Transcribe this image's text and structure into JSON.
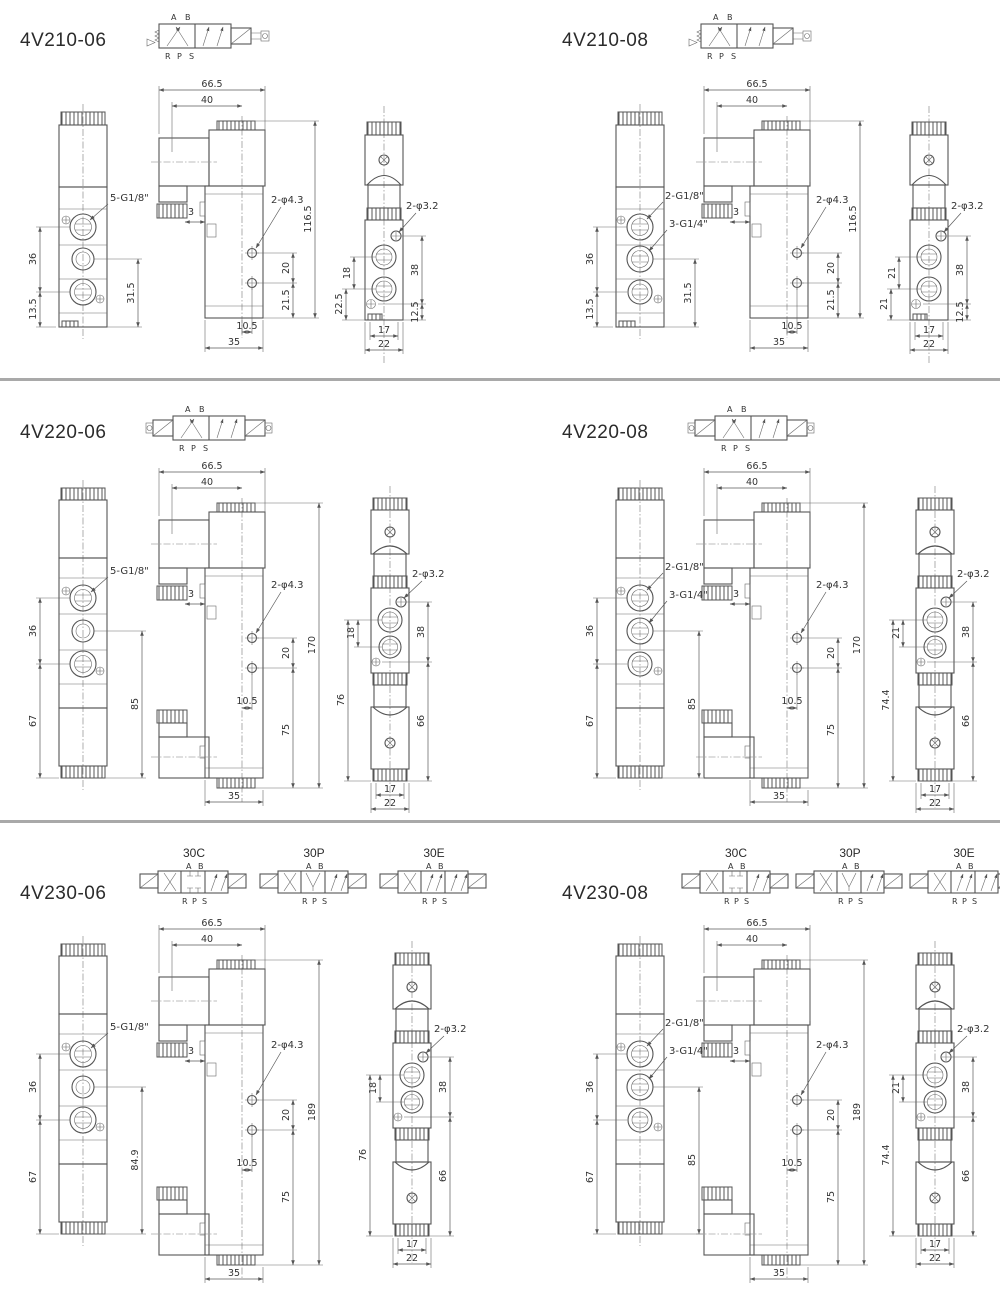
{
  "page": {
    "background": "#ffffff",
    "divider_color": "#a9a9a9",
    "line_color": "#555555"
  },
  "symbols": {
    "ports_top": [
      "A",
      "B"
    ],
    "ports_bottom": [
      "R",
      "P",
      "S"
    ]
  },
  "sections": [
    {
      "title": "4V210-06",
      "valve_type": "5/2 single solenoid spring return",
      "viewA": {
        "thread_label": "5-G1/8\"",
        "dim_span": "36",
        "dim_bottom": "13.5",
        "dim_right": "31.5"
      },
      "viewB": {
        "dim_width": "66.5",
        "dim_width2": "40",
        "dim_offset": "3",
        "hole_label": "2-φ4.3",
        "dim_height": "116.5",
        "dim_h1": "20",
        "dim_h2": "21.5",
        "dim_b1": "10.5",
        "dim_b2": "35"
      },
      "viewC": {
        "hole_label": "2-φ3.2",
        "dim_l1": "18",
        "dim_l2": "22.5",
        "dim_r1": "38",
        "dim_r2": "12.5",
        "dim_b1": "17",
        "dim_b2": "22"
      }
    },
    {
      "title": "4V210-08",
      "valve_type": "5/2 single solenoid spring return",
      "viewA": {
        "thread_label": "2-G1/8\"",
        "thread_label2": "3-G1/4\"",
        "dim_span": "36",
        "dim_bottom": "13.5",
        "dim_right": "31.5"
      },
      "viewB": {
        "dim_width": "66.5",
        "dim_width2": "40",
        "dim_offset": "3",
        "hole_label": "2-φ4.3",
        "dim_height": "116.5",
        "dim_h1": "20",
        "dim_h2": "21.5",
        "dim_b1": "10.5",
        "dim_b2": "35"
      },
      "viewC": {
        "hole_label": "2-φ3.2",
        "dim_l1": "21",
        "dim_l2": "21",
        "dim_r1": "38",
        "dim_r2": "12.5",
        "dim_b1": "17",
        "dim_b2": "22"
      }
    },
    {
      "title": "4V220-06",
      "valve_type": "5/2 double solenoid",
      "viewA": {
        "thread_label": "5-G1/8\"",
        "dim_span": "36",
        "dim_bottom": "67",
        "dim_right": "85"
      },
      "viewB": {
        "dim_width": "66.5",
        "dim_width2": "40",
        "dim_offset": "3",
        "hole_label": "2-φ4.3",
        "dim_height": "170",
        "dim_h1": "20",
        "dim_h2": "75",
        "dim_b1": "10.5",
        "dim_b2": "35"
      },
      "viewC": {
        "hole_label": "2-φ3.2",
        "dim_l1": "18",
        "dim_l2": "76",
        "dim_r1": "38",
        "dim_r2": "66",
        "dim_b1": "17",
        "dim_b2": "22"
      }
    },
    {
      "title": "4V220-08",
      "valve_type": "5/2 double solenoid",
      "viewA": {
        "thread_label": "2-G1/8\"",
        "thread_label2": "3-G1/4\"",
        "dim_span": "36",
        "dim_bottom": "67",
        "dim_right": "85"
      },
      "viewB": {
        "dim_width": "66.5",
        "dim_width2": "40",
        "dim_offset": "3",
        "hole_label": "2-φ4.3",
        "dim_height": "170",
        "dim_h1": "20",
        "dim_h2": "75",
        "dim_b1": "10.5",
        "dim_b2": "35"
      },
      "viewC": {
        "hole_label": "2-φ3.2",
        "dim_l1": "21",
        "dim_l2": "74.4",
        "dim_r1": "38",
        "dim_r2": "66",
        "dim_b1": "17",
        "dim_b2": "22"
      }
    },
    {
      "title": "4V230-06",
      "valve_type": "5/3 double solenoid",
      "variants": [
        "30C",
        "30P",
        "30E"
      ],
      "viewA": {
        "thread_label": "5-G1/8\"",
        "dim_span": "36",
        "dim_bottom": "67",
        "dim_right": "84.9"
      },
      "viewB": {
        "dim_width": "66.5",
        "dim_width2": "40",
        "dim_offset": "3",
        "hole_label": "2-φ4.3",
        "dim_height": "189",
        "dim_h1": "20",
        "dim_h2": "75",
        "dim_b1": "10.5",
        "dim_b2": "35"
      },
      "viewC": {
        "hole_label": "2-φ3.2",
        "dim_l1": "18",
        "dim_l2": "76",
        "dim_r1": "38",
        "dim_r2": "66",
        "dim_b1": "17",
        "dim_b2": "22"
      }
    },
    {
      "title": "4V230-08",
      "valve_type": "5/3 double solenoid",
      "variants": [
        "30C",
        "30P",
        "30E"
      ],
      "viewA": {
        "thread_label": "2-G1/8\"",
        "thread_label2": "3-G1/4\"",
        "dim_span": "36",
        "dim_bottom": "67",
        "dim_right": "85"
      },
      "viewB": {
        "dim_width": "66.5",
        "dim_width2": "40",
        "dim_offset": "3",
        "hole_label": "2-φ4.3",
        "dim_height": "189",
        "dim_h1": "20",
        "dim_h2": "75",
        "dim_b1": "10.5",
        "dim_b2": "35"
      },
      "viewC": {
        "hole_label": "2-φ3.2",
        "dim_l1": "21",
        "dim_l2": "74.4",
        "dim_r1": "38",
        "dim_r2": "66",
        "dim_b1": "17",
        "dim_b2": "22"
      }
    }
  ]
}
